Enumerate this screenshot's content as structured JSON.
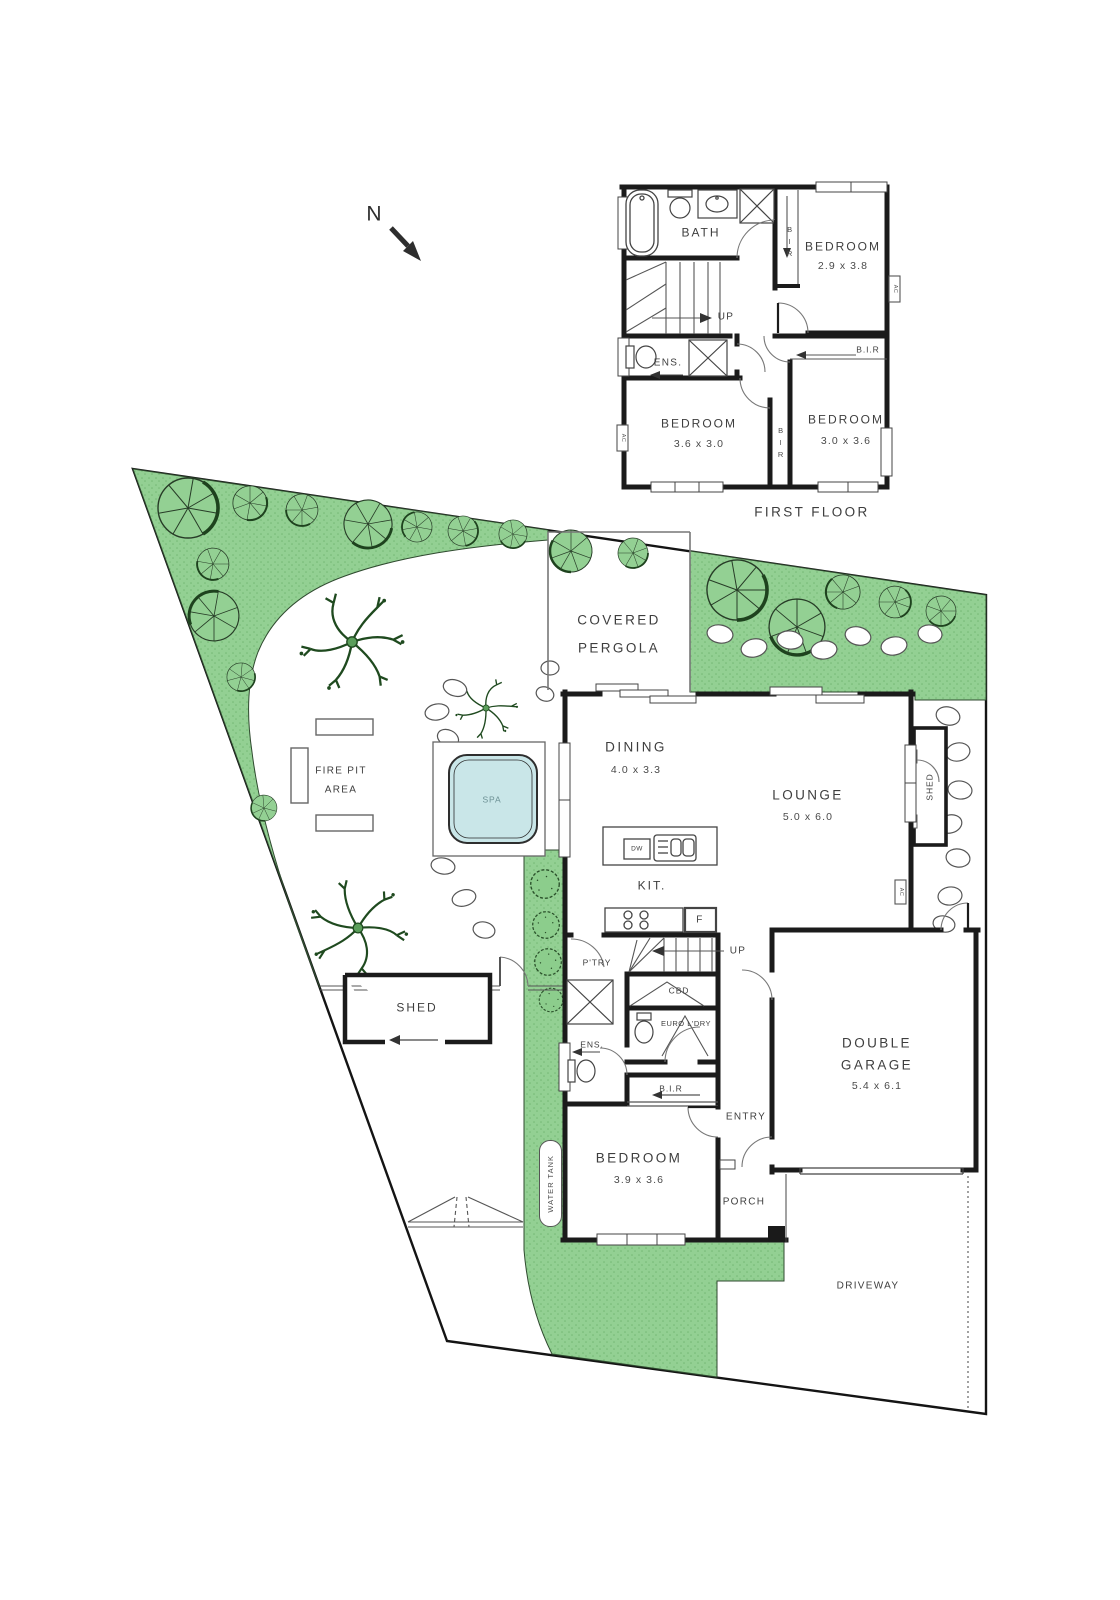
{
  "compass": {
    "north": "N"
  },
  "first_floor": {
    "title": "FIRST FLOOR",
    "bath": "BATH",
    "ens": "ENS.",
    "up": "UP",
    "ac": "AC",
    "bir_closet": "BIR",
    "bir_mid": "BIR",
    "bir_robe": "B.I.R",
    "bed_top": {
      "name": "BEDROOM",
      "dims": "2.9 x 3.8"
    },
    "bed_left": {
      "name": "BEDROOM",
      "dims": "3.6 x 3.0"
    },
    "bed_right": {
      "name": "BEDROOM",
      "dims": "3.0 x 3.6"
    }
  },
  "ground_floor": {
    "pergola_line1": "COVERED",
    "pergola_line2": "PERGOLA",
    "dining": {
      "name": "DINING",
      "dims": "4.0 x 3.3"
    },
    "lounge": {
      "name": "LOUNGE",
      "dims": "5.0 x 6.0"
    },
    "kitchen": "KIT.",
    "dw": "DW",
    "fridge": "F",
    "up": "UP",
    "pantry": "P'TRY",
    "cbd": "CBD",
    "laundry": "EURO L'DRY",
    "ens": "ENS.",
    "bir": "B.I.R",
    "bedroom": {
      "name": "BEDROOM",
      "dims": "3.9 x 3.6"
    },
    "entry": "ENTRY",
    "porch": "PORCH",
    "garage": {
      "line1": "DOUBLE",
      "line2": "GARAGE",
      "dims": "5.4 x 6.1"
    },
    "ac": "AC"
  },
  "site": {
    "driveway": "DRIVEWAY",
    "shed_left": "SHED",
    "shed_right": "SHED",
    "fire_pit_line1": "FIRE PIT",
    "fire_pit_line2": "AREA",
    "spa": "SPA",
    "water_tank": "WATER TANK"
  },
  "colors": {
    "grass": "#93d093",
    "grass_dot": "#74b874",
    "tree_line": "#1e421e",
    "spa_water": "#c9e6e8",
    "wall": "#1b1b1b",
    "text": "#3e3e3e"
  }
}
